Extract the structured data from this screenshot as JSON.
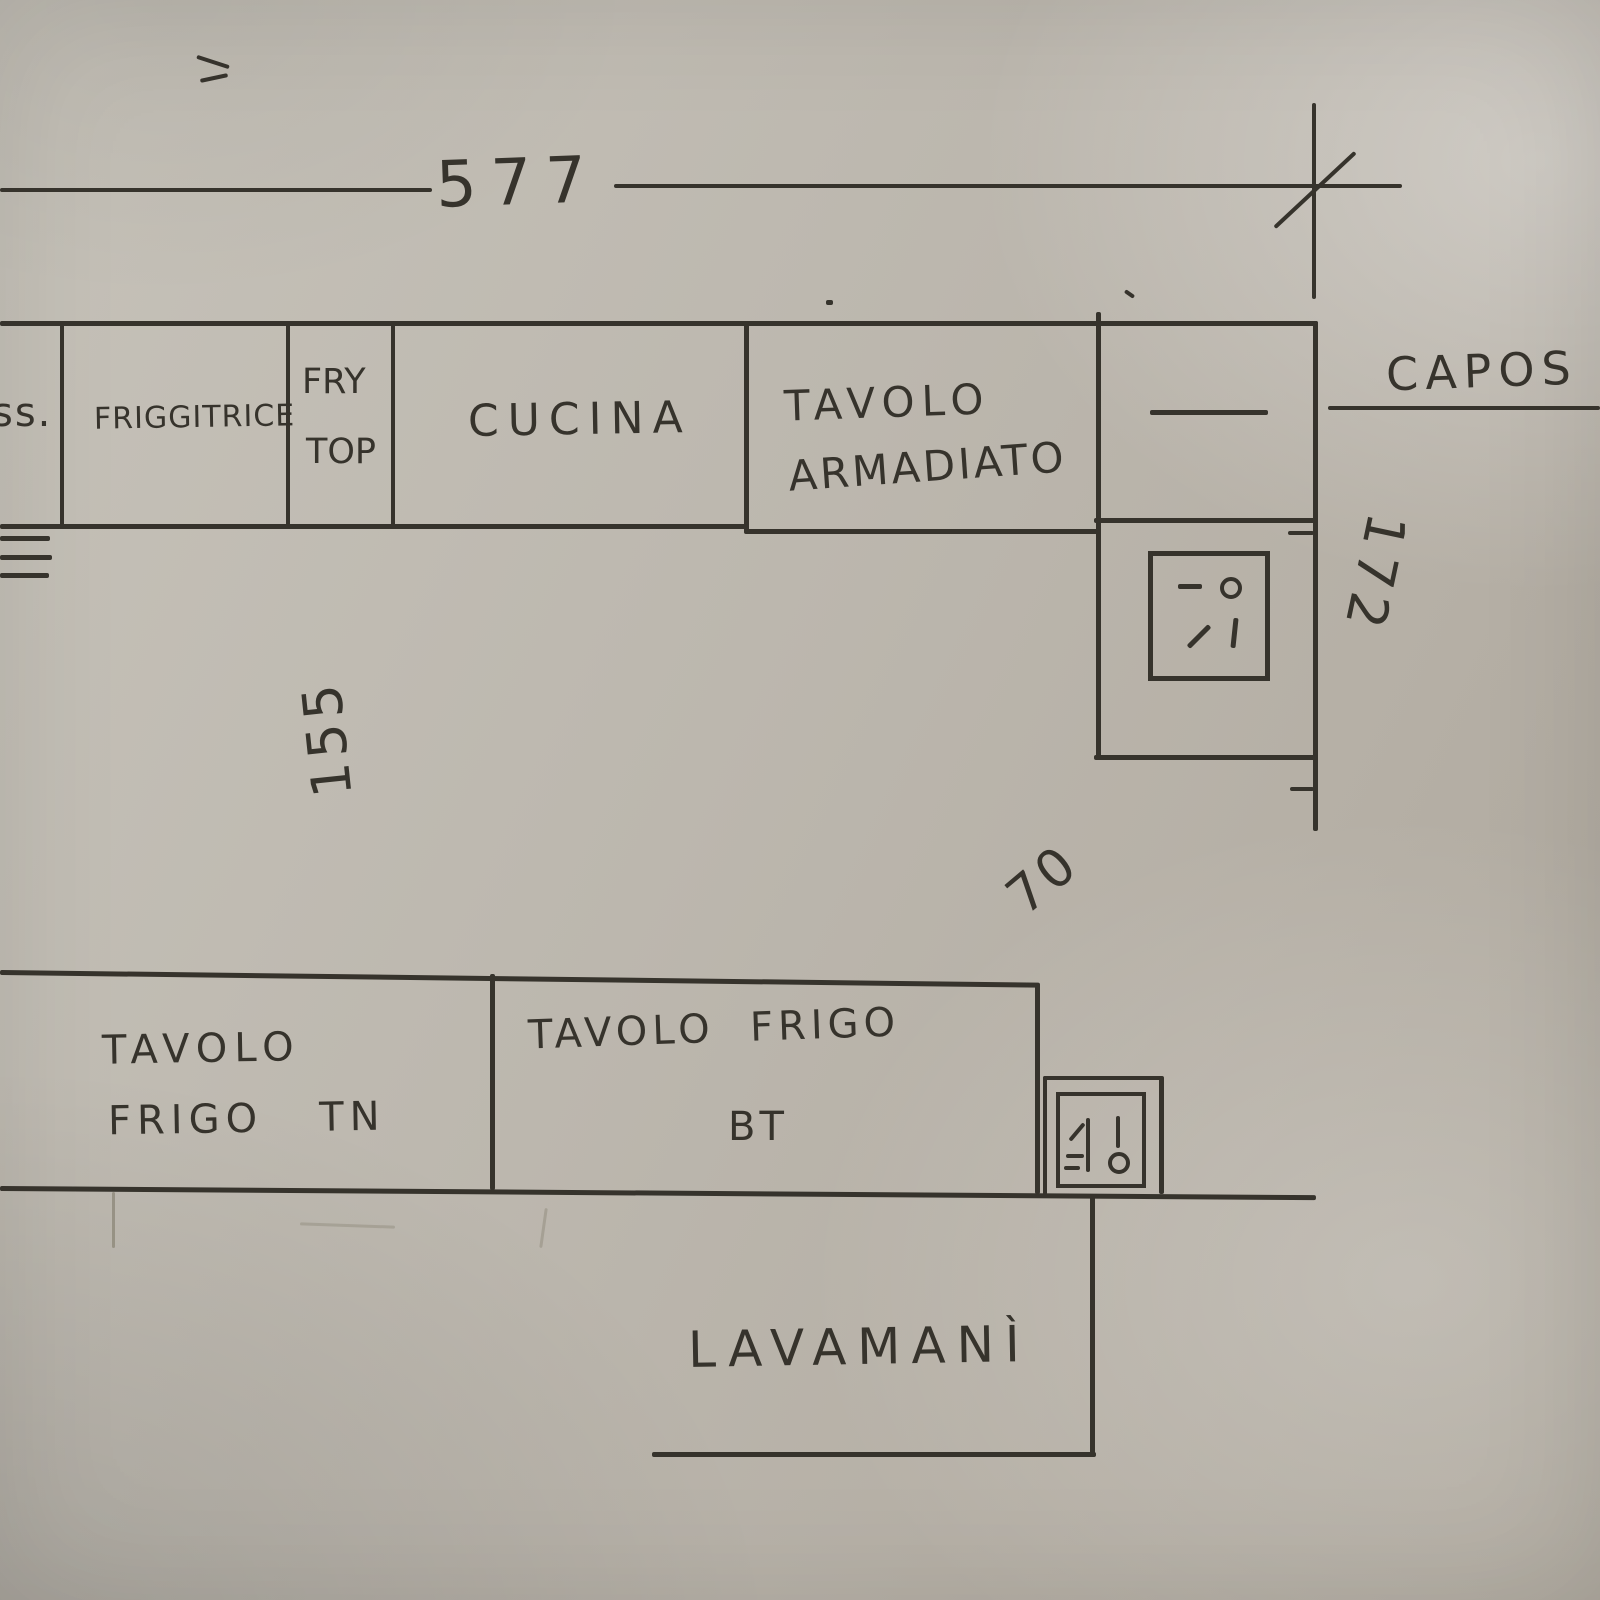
{
  "colors": {
    "paper": "#bcb7ae",
    "ink": "#36332c",
    "pencil": "#8f897b"
  },
  "plan": {
    "dim_width_label": "577",
    "dim_height_label": "172",
    "dim_depth_label": "155",
    "dim_gap_label": "70",
    "top_row": {
      "cell_partial": "ss.",
      "cell_friggitrice": "FRIGGITRICE",
      "cell_fry_line1": "FRY",
      "cell_fry_line2": "TOP",
      "cell_cucina": "CUCINA",
      "cell_tavolo_line1": "TAVOLO",
      "cell_tavolo_line2": "ARMADIATO"
    },
    "annotation_capos": "CAPOS",
    "bottom_row": {
      "tn_line1": "TAVOLO",
      "tn_line2": "FRIGO   TN",
      "bt_line1": "TAVOLO  FRIGO",
      "bt_line2": "BT"
    },
    "lavamani_label": "LAVAMANÌ"
  }
}
